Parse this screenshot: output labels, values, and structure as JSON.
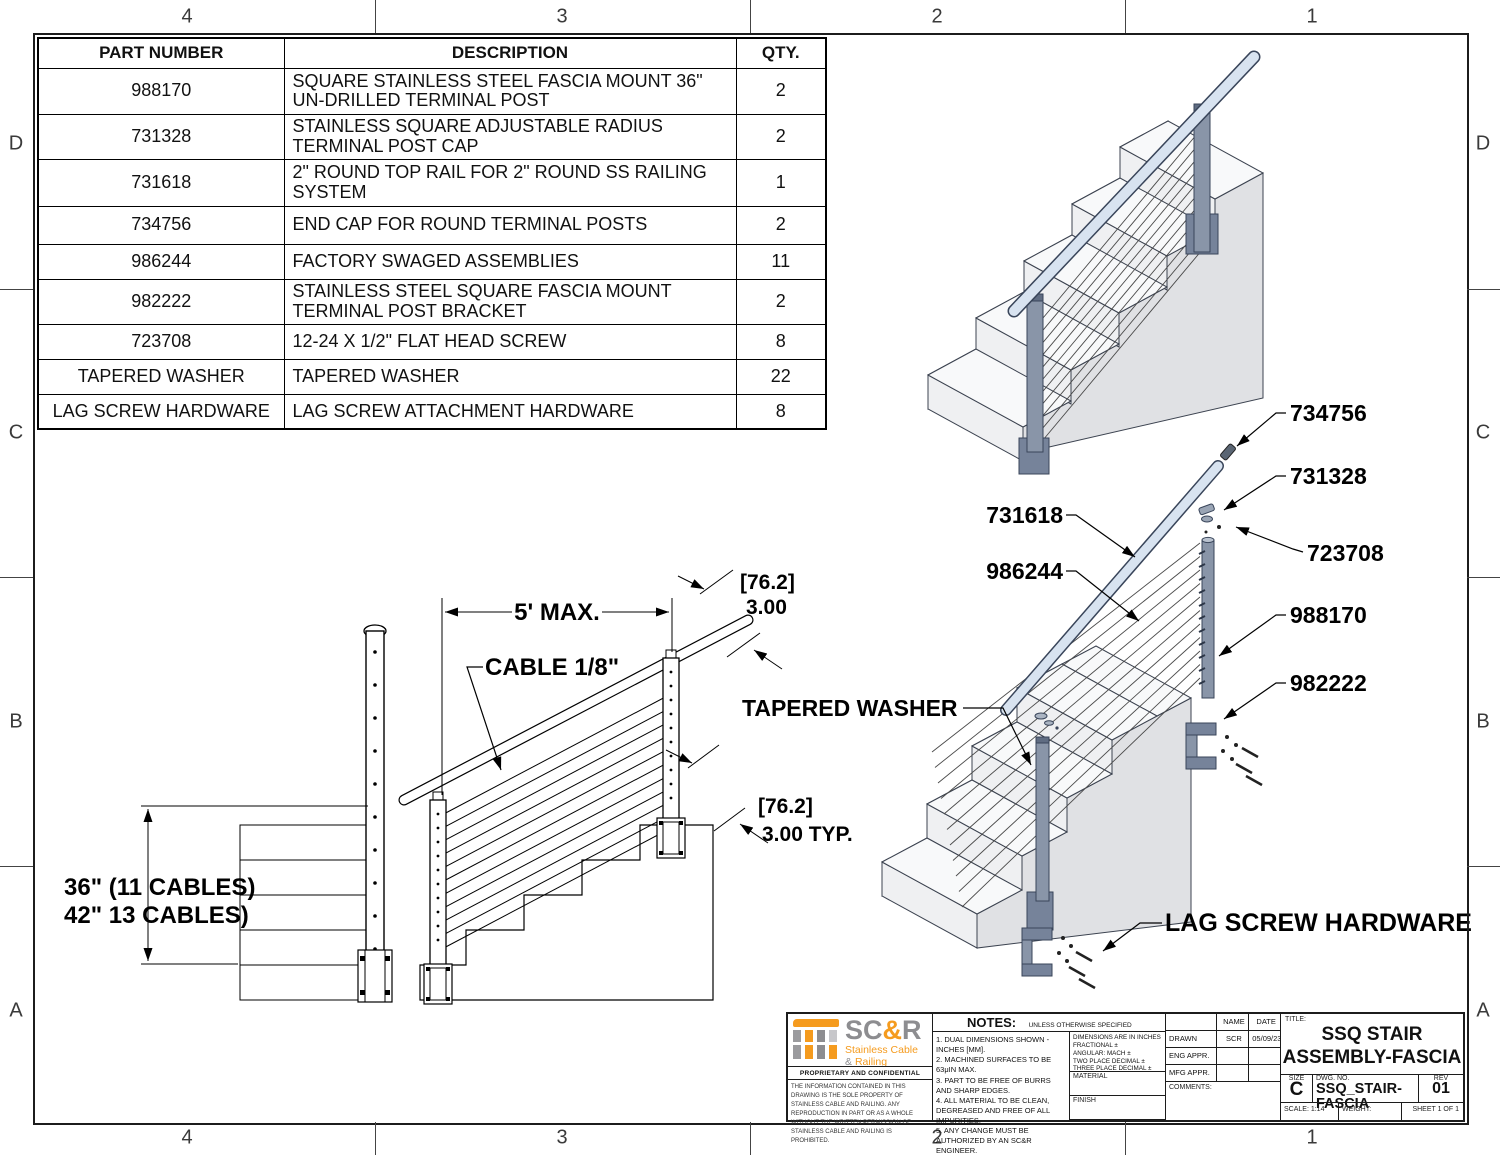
{
  "zones": {
    "top": [
      "4",
      "3",
      "2",
      "1"
    ],
    "bottom": [
      "4",
      "3",
      "2",
      "1"
    ],
    "left": [
      "D",
      "C",
      "B",
      "A"
    ],
    "right": [
      "D",
      "C",
      "B",
      "A"
    ]
  },
  "parts_table": {
    "headers": {
      "part": "PART NUMBER",
      "desc": "DESCRIPTION",
      "qty": "QTY."
    },
    "rows": [
      {
        "part": "988170",
        "desc": "SQUARE STAINLESS STEEL FASCIA MOUNT 36\" UN-DRILLED TERMINAL POST",
        "qty": "2"
      },
      {
        "part": "731328",
        "desc": "STAINLESS SQUARE ADJUSTABLE RADIUS TERMINAL POST CAP",
        "qty": "2"
      },
      {
        "part": "731618",
        "desc": "2\" ROUND TOP RAIL FOR 2\" ROUND SS RAILING SYSTEM",
        "qty": "1"
      },
      {
        "part": "734756",
        "desc": "END CAP FOR ROUND TERMINAL POSTS",
        "qty": "2"
      },
      {
        "part": "986244",
        "desc": "FACTORY SWAGED ASSEMBLIES",
        "qty": "11"
      },
      {
        "part": "982222",
        "desc": "STAINLESS STEEL SQUARE FASCIA MOUNT TERMINAL POST BRACKET",
        "qty": "2"
      },
      {
        "part": "723708",
        "desc": "12-24 X 1/2\" FLAT HEAD SCREW",
        "qty": "8"
      },
      {
        "part": "TAPERED WASHER",
        "desc": "TAPERED WASHER",
        "qty": "22"
      },
      {
        "part": "LAG SCREW HARDWARE",
        "desc": "LAG SCREW ATTACHMENT HARDWARE",
        "qty": "8"
      }
    ]
  },
  "callouts": {
    "end_cap": "734756",
    "post_cap": "731328",
    "screw": "723708",
    "terminal_post": "988170",
    "post_bracket": "982222",
    "top_rail": "731618",
    "swaged_assembly": "986244",
    "tapered_washer": "TAPERED WASHER",
    "lag_screw": "LAG SCREW HARDWARE"
  },
  "dimensions": {
    "span": "5' MAX.",
    "cable": "CABLE 1/8\"",
    "spacing_mm": "[76.2]",
    "spacing_in": "3.00",
    "spacing_mm2": "[76.2]",
    "spacing_in_typ": "3.00  TYP.",
    "height_line1": "36\" (11 CABLES)",
    "height_line2": "42\" 13 CABLES)"
  },
  "title_block": {
    "logo": {
      "sc": "SC",
      "amp": "&",
      "r": "R",
      "tag1": "Stainless Cable",
      "tag2_amp": "&",
      "tag2_word": "Railing"
    },
    "proprietary_title": "PROPRIETARY AND CONFIDENTIAL",
    "proprietary_text": "THE INFORMATION CONTAINED IN THIS DRAWING IS THE SOLE PROPERTY OF STAINLESS CABLE AND RAILING. ANY REPRODUCTION IN PART OR AS A WHOLE WITHOUT THE WRITTEN PERMISSION OF STAINLESS CABLE AND RAILING IS PROHIBITED.",
    "notes_title": "NOTES:",
    "notes_condition": "UNLESS OTHERWISE SPECIFIED",
    "notes": [
      "1. DUAL DIMENSIONS SHOWN - INCHES [MM].",
      "2. MACHINED SURFACES TO BE 63μIN MAX.",
      "3. PART TO BE FREE OF BURRS AND SHARP EDGES.",
      "4. ALL MATERIAL TO BE CLEAN, DEGREASED AND FREE OF ALL IMPURITIES.",
      "5. ANY CHANGE MUST BE AUTHORIZED BY AN SC&R ENGINEER."
    ],
    "tolerances": [
      "DIMENSIONS ARE IN INCHES",
      "FRACTIONAL ±",
      "ANGULAR: MACH ±",
      "TWO PLACE DECIMAL ±",
      "THREE PLACE DECIMAL ±"
    ],
    "material_label": "MATERIAL",
    "finish_label": "FINISH",
    "name_label": "NAME",
    "date_label": "DATE",
    "drawn_label": "DRAWN",
    "drawn_name": "SCR",
    "drawn_date": "05/09/23",
    "eng_label": "ENG APPR.",
    "mfg_label": "MFG APPR.",
    "comments_label": "COMMENTS:",
    "title_label": "TITLE:",
    "title_line1": "SSQ STAIR",
    "title_line2": "ASSEMBLY-FASCIA",
    "size_label": "SIZE",
    "size": "C",
    "dwg_label": "DWG.  NO.",
    "dwg_no": "SSQ_STAIR-FASCIA",
    "rev_label": "REV",
    "rev": "01",
    "scale": "SCALE: 1:14",
    "weight": "WEIGHT:",
    "sheet": "SHEET 1 OF 1"
  },
  "colors": {
    "accent_orange": "#F59B1E",
    "logo_gray": "#8D8D90",
    "steel": "#8995A8",
    "rail": "#D8E3F0"
  }
}
